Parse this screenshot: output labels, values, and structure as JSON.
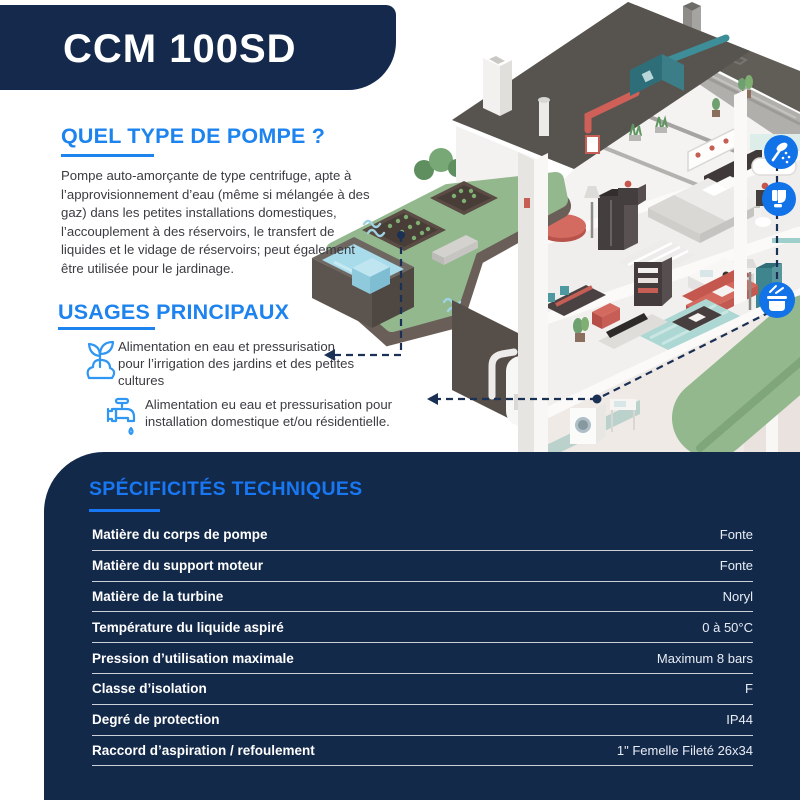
{
  "header": {
    "title": "CCM 100SD"
  },
  "sections": {
    "pump_type": {
      "heading": "QUEL TYPE DE POMPE ?",
      "body": "Pompe auto-amorçante de type centrifuge, apte à l’approvisionnement d’eau (même si mélangée à des gaz) dans les petites installations domestiques, l’accouplement à des réservoirs, le transfert de liquides et le vidage de réservoirs; peut également être utilisée pour le jardinage."
    },
    "usages": {
      "heading": "USAGES PRINCIPAUX",
      "items": [
        {
          "icon": "sprout-icon",
          "text": "Alimentation en eau et pressurisation pour l’irrigation des jardins et des petites cultures"
        },
        {
          "icon": "faucet-icon",
          "text": "Alimentation eu eau et pressurisation pour installation domestique et/ou résidentielle."
        }
      ]
    },
    "specs": {
      "heading": "SPÉCIFICITÉS TECHNIQUES",
      "rows": [
        {
          "label": "Matière du corps de pompe",
          "value": "Fonte"
        },
        {
          "label": "Matière du support moteur",
          "value": "Fonte"
        },
        {
          "label": "Matière de la turbine",
          "value": "Noryl"
        },
        {
          "label": "Température du liquide aspiré",
          "value": "0 à 50°C"
        },
        {
          "label": "Pression d’utilisation maximale",
          "value": "Maximum 8 bars"
        },
        {
          "label": "Classe d’isolation",
          "value": "F"
        },
        {
          "label": "Degré de protection",
          "value": "IP44"
        },
        {
          "label": "Raccord d’aspiration / refoulement",
          "value": "1\" Femelle Fileté 26x34"
        }
      ]
    }
  },
  "illustration": {
    "name": "isometric-house-cutaway",
    "markers": [
      "shower-icon",
      "toilet-icon",
      "cooking-pot-icon"
    ]
  },
  "colors": {
    "navy": "#14294B",
    "heading_blue": "#1D83EE",
    "panel_heading_blue": "#1877F2",
    "usage_icon_blue": "#2F97F3",
    "marker_circle_blue": "#1273E8",
    "roof_gray": "#57544F",
    "lawn_green": "#93B88E",
    "water_blue": "#A9DCEA",
    "sofa_red": "#D4695F",
    "teal": "#4E99A0"
  }
}
